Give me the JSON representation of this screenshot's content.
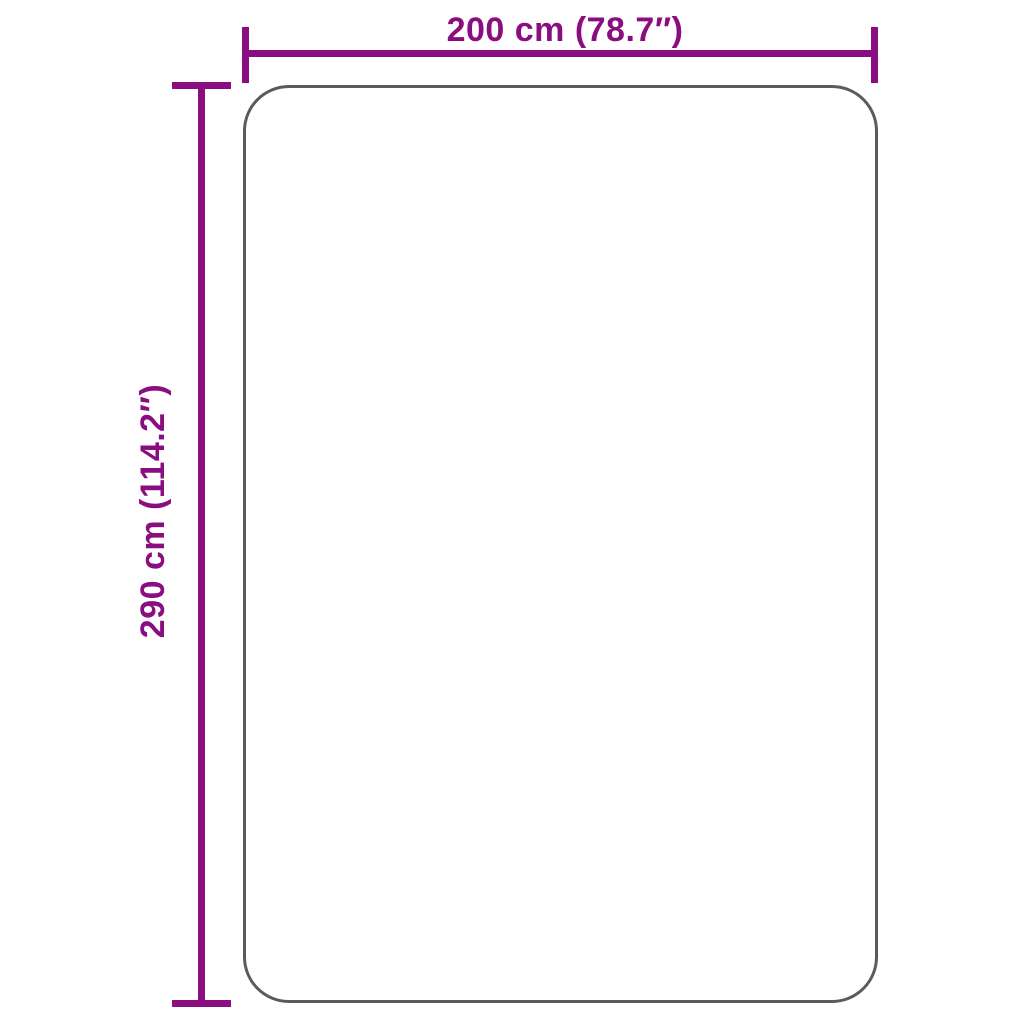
{
  "diagram": {
    "type": "product-dimension-diagram",
    "width_dimension": {
      "label": "200 cm (78.7″)",
      "value_cm": 200,
      "value_inches": 78.7
    },
    "height_dimension": {
      "label": "290 cm (114.2″)",
      "value_cm": 290,
      "value_inches": 114.2
    },
    "colors": {
      "accent": "#8A0E7F",
      "outline": "#5B5B5D",
      "background": "#FFFFFF"
    }
  }
}
